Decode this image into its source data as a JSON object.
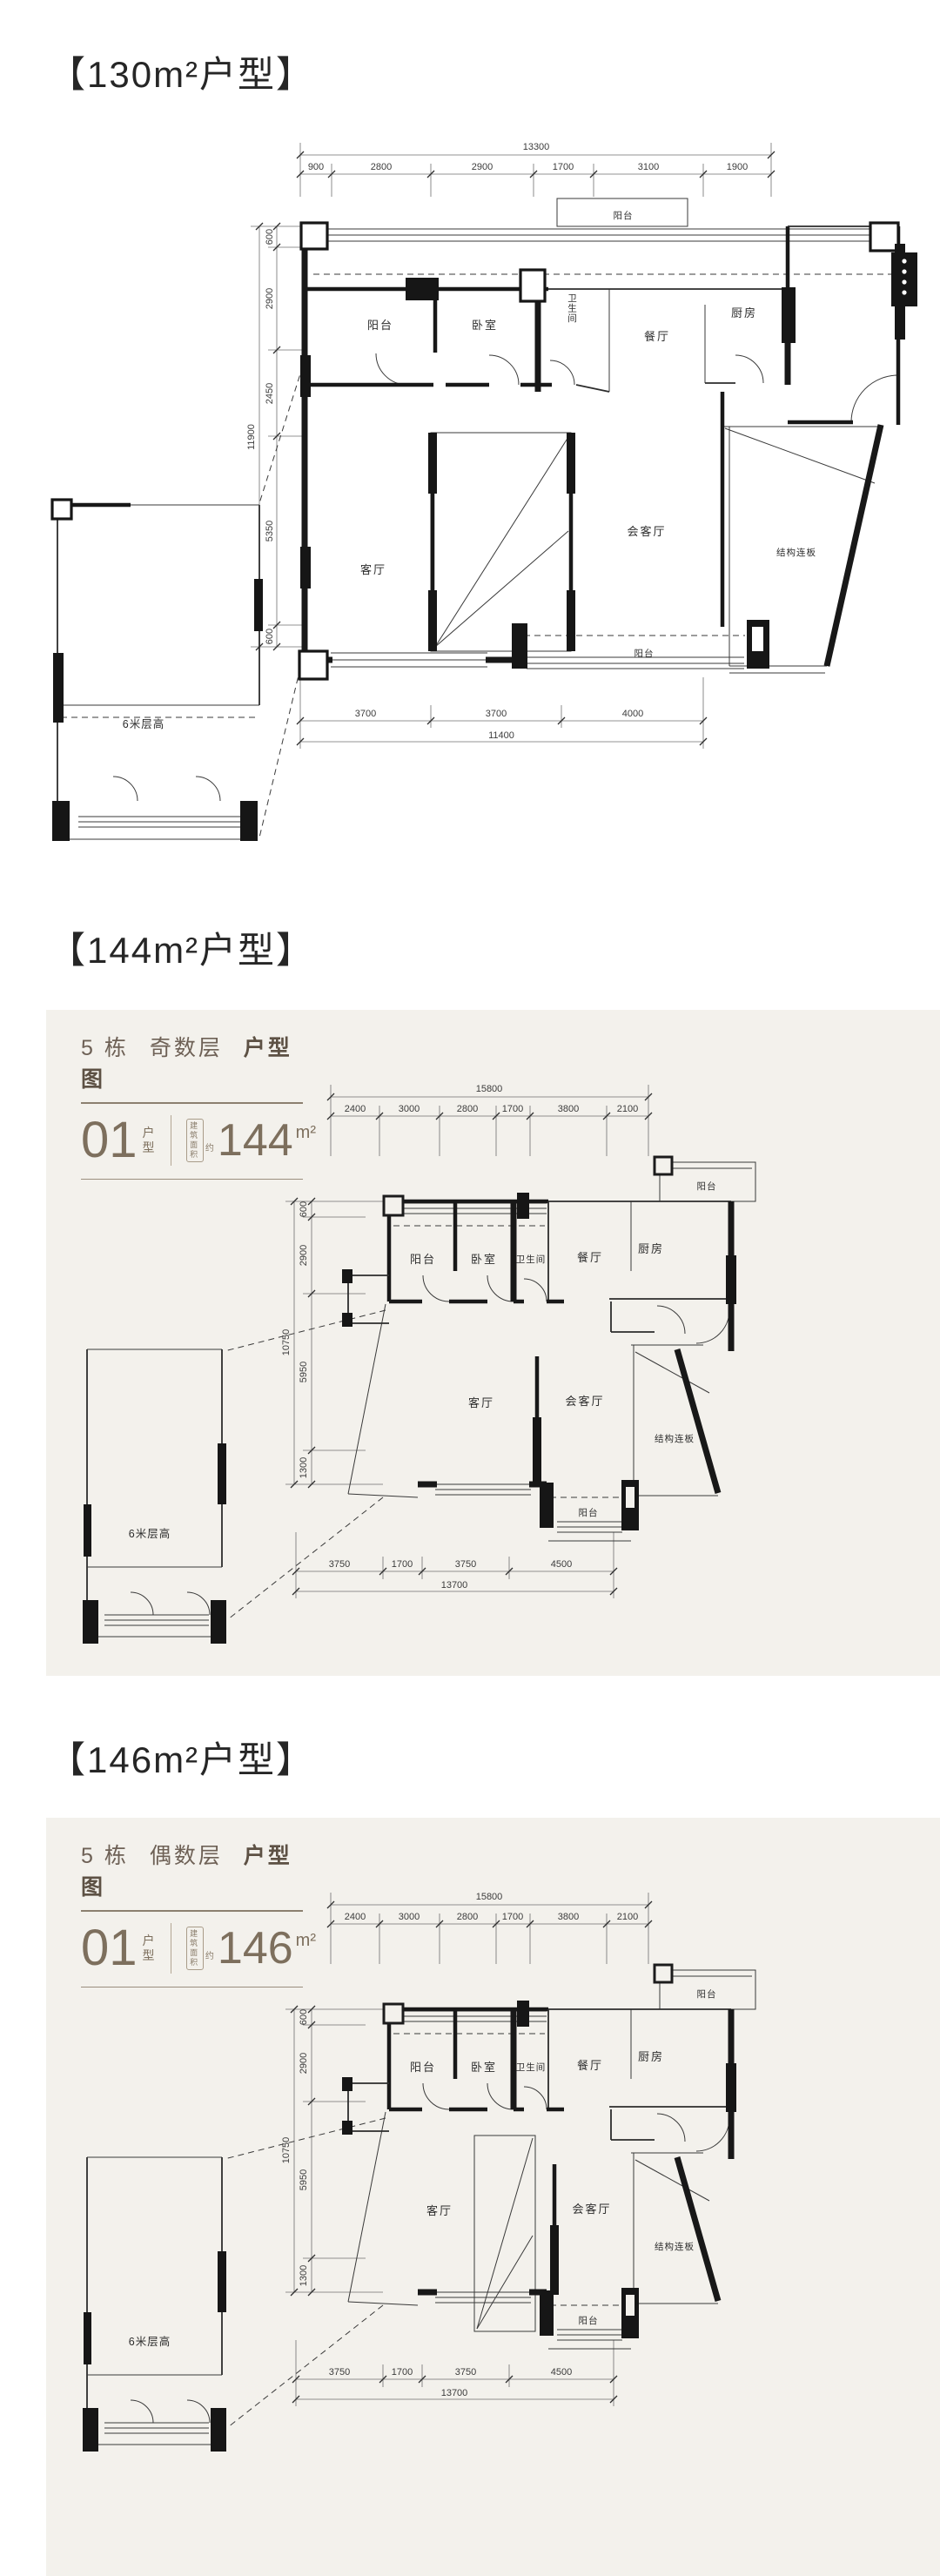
{
  "colors": {
    "page_bg": "#ffffff",
    "card_bg": "#f3f1ec",
    "ink": "#181818",
    "dim_text": "#3c3c3c",
    "header_brown": "#6e6156",
    "accent_brown": "#7d6f5d"
  },
  "section130": {
    "title": "【130m²户型】",
    "plan": {
      "dims": {
        "top_total": "13300",
        "top": [
          "900",
          "2800",
          "2900",
          "1700",
          "3100",
          "1900"
        ],
        "left_total": "11900",
        "left": [
          "600",
          "2900",
          "2450",
          "5350",
          "600"
        ],
        "bottom": [
          "3700",
          "3700",
          "4000"
        ],
        "bottom_total": "11400"
      },
      "rooms": {
        "balcony_top": "阳台",
        "balcony_left": "阳台",
        "bedroom": "卧室",
        "bathroom": "卫生间",
        "dining": "餐厅",
        "kitchen": "厨房",
        "living": "客厅",
        "family": "会客厅",
        "slab": "结构连板",
        "balcony_bottom": "阳台",
        "annex": "6米层高"
      }
    }
  },
  "section144": {
    "title": "【144m²户型】",
    "card": {
      "building": "5 栋",
      "parity": "奇数层",
      "doc": "户型图",
      "unit_no": "01",
      "unit_word_1": "户",
      "unit_word_2": "型",
      "area_badge_1": "建筑",
      "area_badge_2": "面积",
      "area_approx": "约",
      "area_value": "144",
      "area_unit": "m²"
    },
    "plan": {
      "dims": {
        "top_total": "15800",
        "top": [
          "2400",
          "3000",
          "2800",
          "1700",
          "3800",
          "2100"
        ],
        "left_total": "10750",
        "left": [
          "600",
          "2900",
          "5950",
          "1300"
        ],
        "bottom": [
          "3750",
          "1700",
          "3750",
          "4500"
        ],
        "bottom_total": "13700"
      },
      "rooms": {
        "balcony_top": "阳台",
        "balcony_left": "阳台",
        "bedroom": "卧室",
        "bathroom": "卫生间",
        "dining": "餐厅",
        "kitchen": "厨房",
        "living": "客厅",
        "family": "会客厅",
        "slab": "结构连板",
        "balcony_bottom": "阳台",
        "annex": "6米层高"
      }
    }
  },
  "section146": {
    "title": "【146m²户型】",
    "card": {
      "building": "5 栋",
      "parity": "偶数层",
      "doc": "户型图",
      "unit_no": "01",
      "unit_word_1": "户",
      "unit_word_2": "型",
      "area_badge_1": "建筑",
      "area_badge_2": "面积",
      "area_approx": "约",
      "area_value": "146",
      "area_unit": "m²"
    },
    "plan": {
      "dims": {
        "top_total": "15800",
        "top": [
          "2400",
          "3000",
          "2800",
          "1700",
          "3800",
          "2100"
        ],
        "left_total": "10750",
        "left": [
          "600",
          "2900",
          "5950",
          "1300"
        ],
        "bottom": [
          "3750",
          "1700",
          "3750",
          "4500"
        ],
        "bottom_total": "13700"
      },
      "rooms": {
        "balcony_top": "阳台",
        "balcony_left": "阳台",
        "bedroom": "卧室",
        "bathroom": "卫生间",
        "dining": "餐厅",
        "kitchen": "厨房",
        "living": "客厅",
        "family": "会客厅",
        "slab": "结构连板",
        "balcony_bottom": "阳台",
        "annex": "6米层高"
      }
    }
  }
}
